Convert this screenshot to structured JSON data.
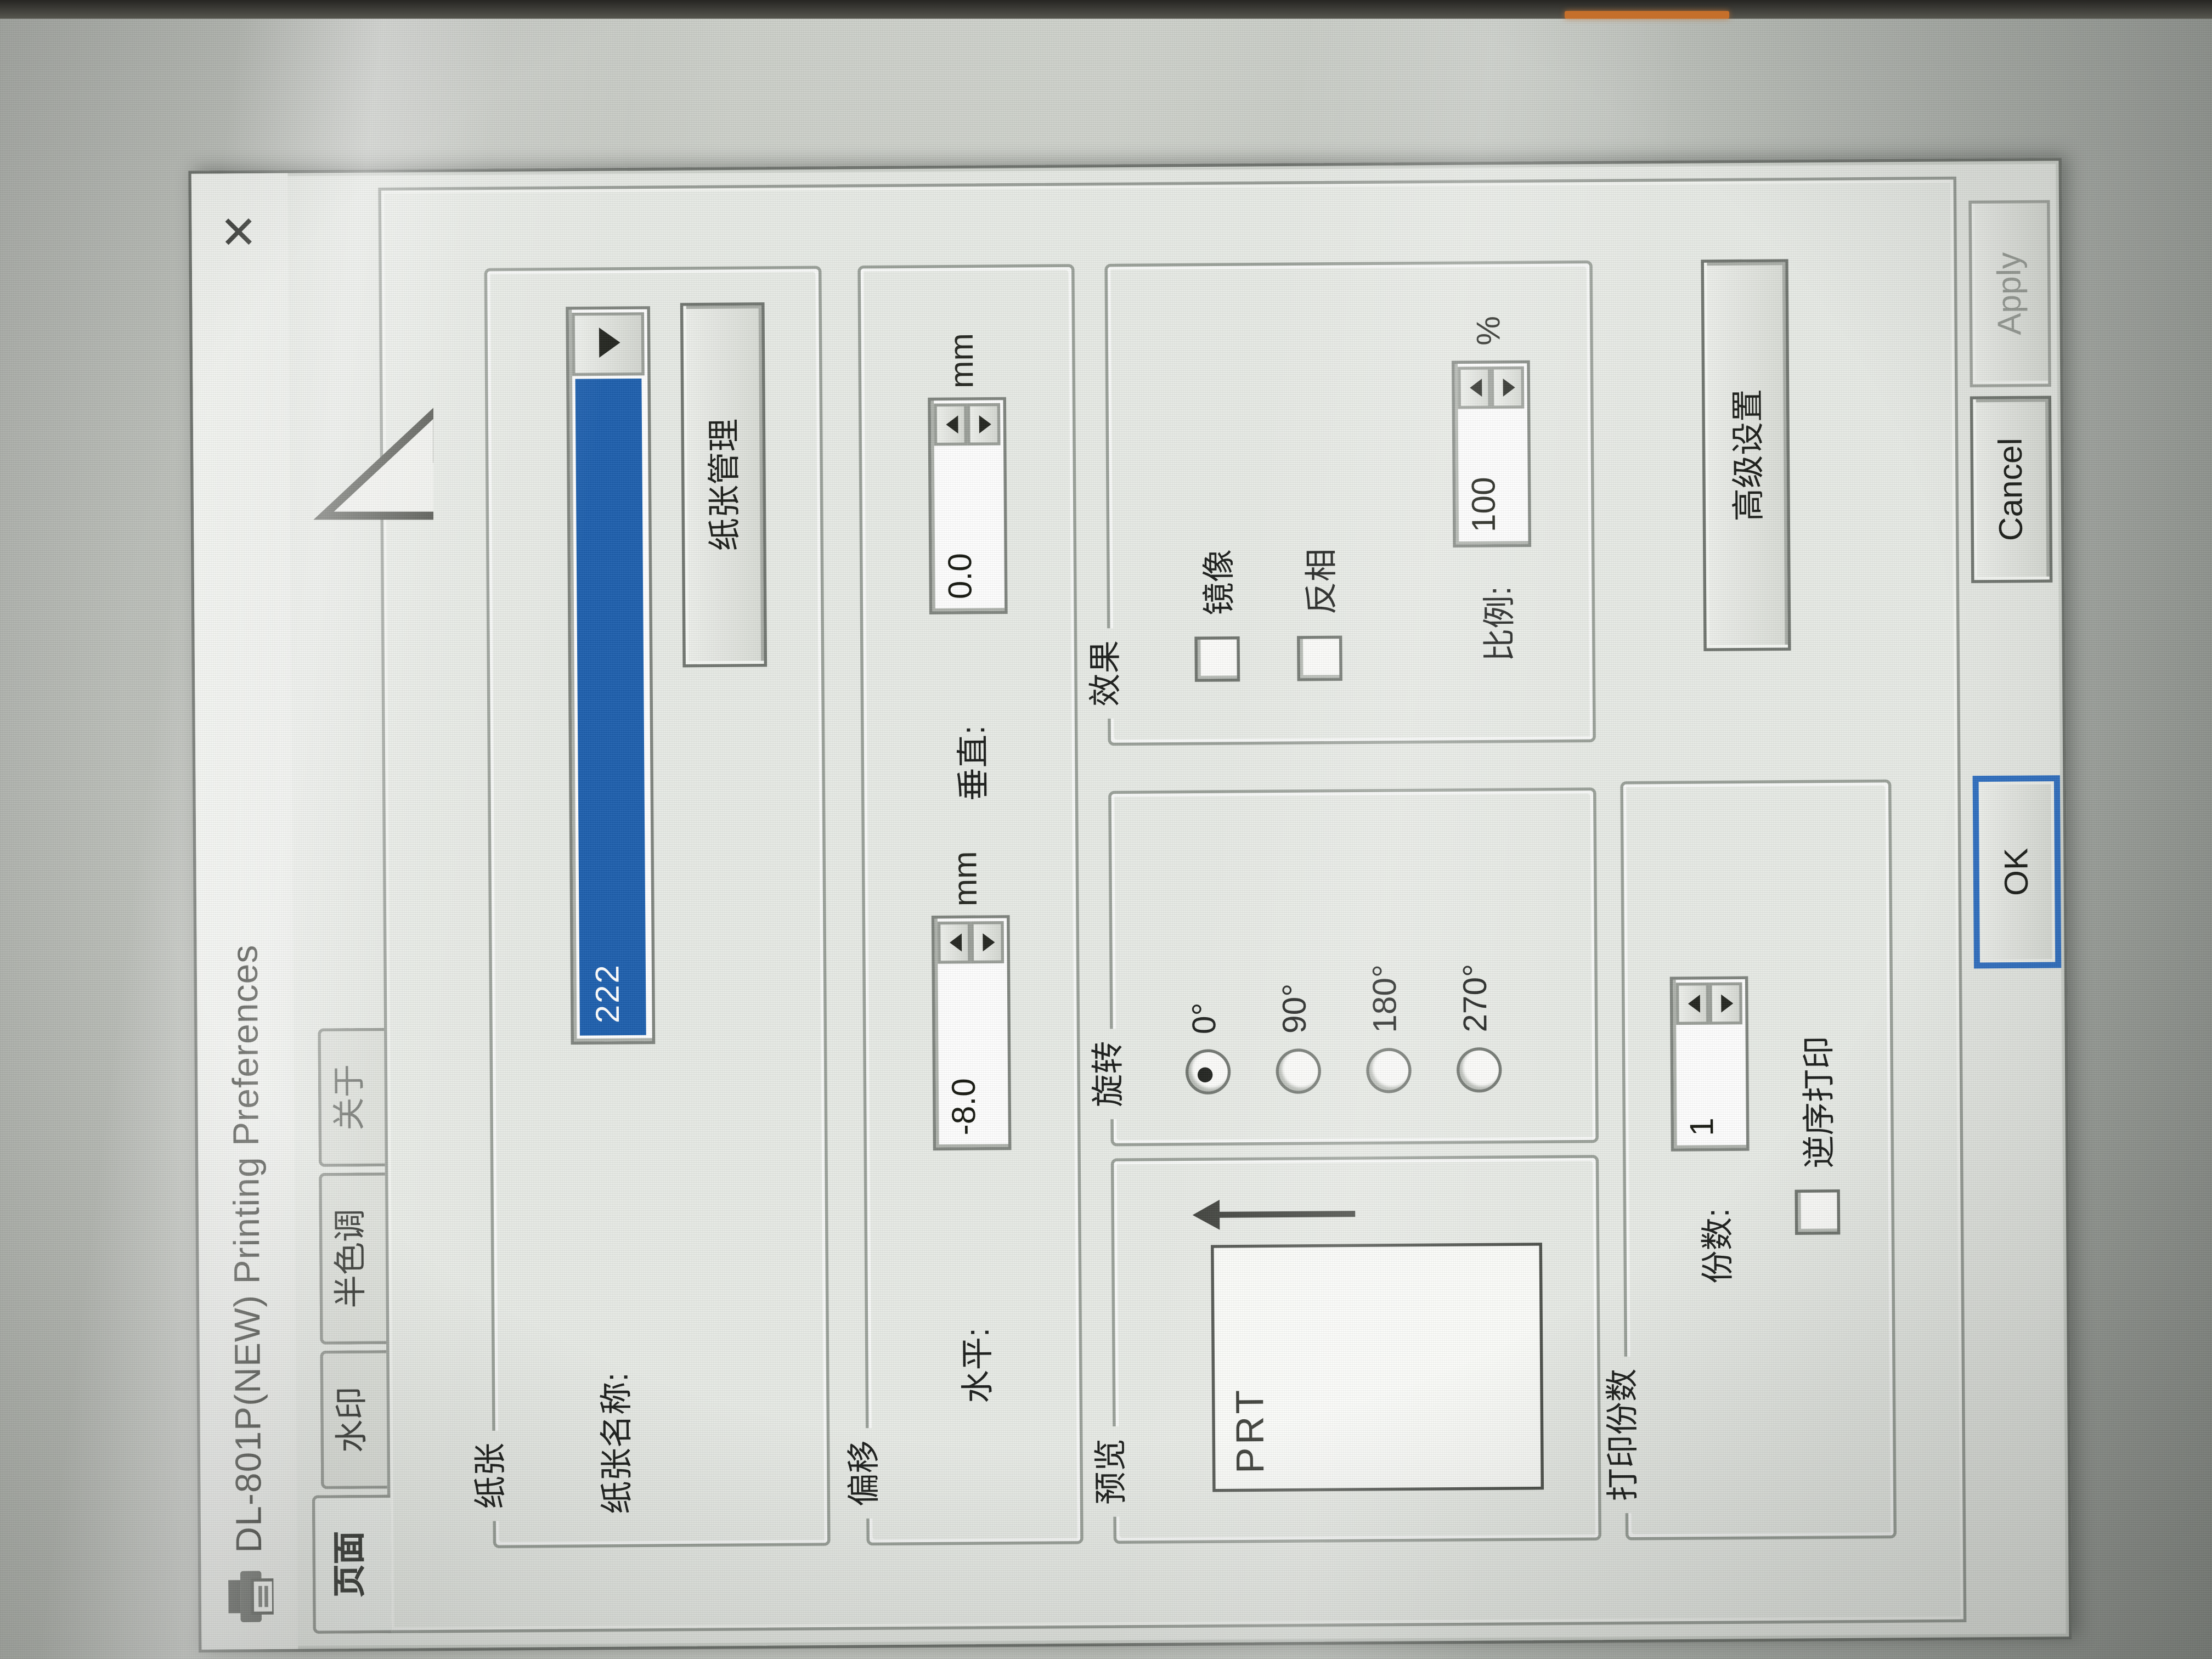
{
  "window": {
    "title": "DL-801P(NEW) Printing Preferences",
    "close_glyph": "✕"
  },
  "tabs": {
    "active": "页面",
    "items": [
      {
        "label": "页面"
      },
      {
        "label": "水印"
      },
      {
        "label": "半色调"
      },
      {
        "label": "关于"
      }
    ]
  },
  "paper": {
    "group_label": "纸张",
    "name_label": "纸张名称:",
    "name_value": "222",
    "manage_button": "纸张管理"
  },
  "offset": {
    "group_label": "偏移",
    "horizontal_label": "水平:",
    "horizontal_value": "-8.0",
    "horizontal_unit": "mm",
    "vertical_label": "垂直:",
    "vertical_value": "0.0",
    "vertical_unit": "mm"
  },
  "preview": {
    "group_label": "预览",
    "page_text": "PRT"
  },
  "rotation": {
    "group_label": "旋转",
    "selected": "0°",
    "options": [
      {
        "label": "0°",
        "selected": true
      },
      {
        "label": "90°",
        "selected": false
      },
      {
        "label": "180°",
        "selected": false
      },
      {
        "label": "270°",
        "selected": false
      }
    ]
  },
  "effect": {
    "group_label": "效果",
    "mirror_label": "镜像",
    "mirror_checked": false,
    "invert_label": "反相",
    "invert_checked": false,
    "scale_label": "比例:",
    "scale_value": "100",
    "scale_unit": "%"
  },
  "copies": {
    "group_label": "打印份数",
    "count_label": "份数:",
    "count_value": "1",
    "reverse_label": "逆序打印",
    "reverse_checked": false
  },
  "advanced": {
    "button_label": "高级设置"
  },
  "footer": {
    "ok": "OK",
    "cancel": "Cancel",
    "apply": "Apply"
  },
  "colors": {
    "selection_blue": "#1d5fae",
    "focus_blue": "#2f6fc1",
    "bezel_accent_orange": "#c56f2b"
  }
}
